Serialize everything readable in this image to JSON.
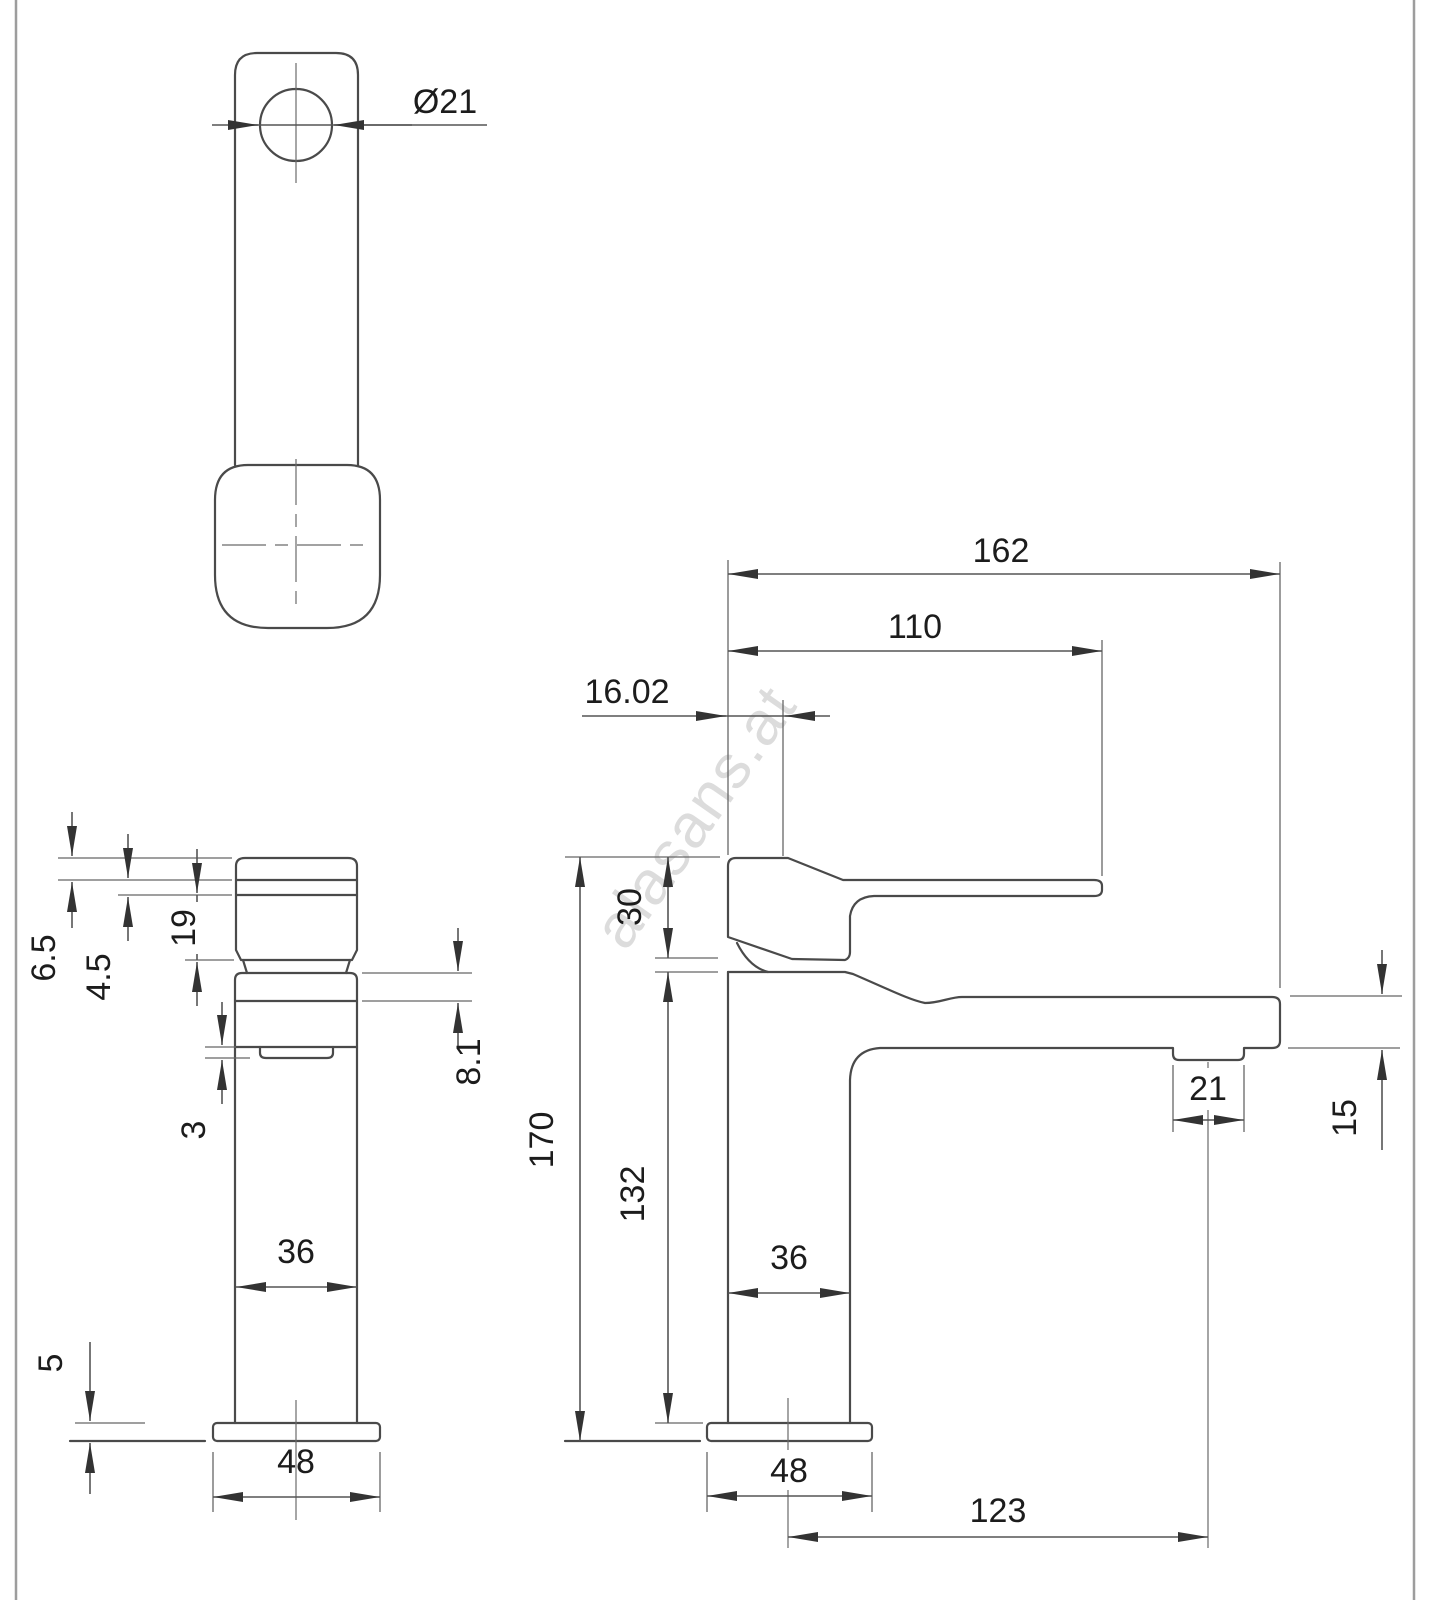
{
  "drawing": {
    "type": "technical-cad-dimension-drawing",
    "subject": "single-lever basin mixer faucet, three orthographic views",
    "units": "mm",
    "watermark": "alasans.at",
    "colors": {
      "line": "#4a4a4a",
      "dimension": "#555555",
      "watermark": "#c7c7c7",
      "background": "#ffffff"
    }
  },
  "dims": {
    "top": {
      "hole_dia": "Ø21"
    },
    "front": {
      "cap": "6.5",
      "ring": "4.5",
      "handle": "19",
      "aerator_lip": "3",
      "ledge": "8.1",
      "width": "36",
      "base_h": "5",
      "base_w": "48"
    },
    "side": {
      "reach_total": "162",
      "lever": "110",
      "offset": "16.02",
      "handle_rise": "30",
      "height_total": "170",
      "height_body": "132",
      "depth": "36",
      "aerator": "21",
      "tip": "15",
      "base": "48",
      "spout_proj": "123"
    }
  }
}
